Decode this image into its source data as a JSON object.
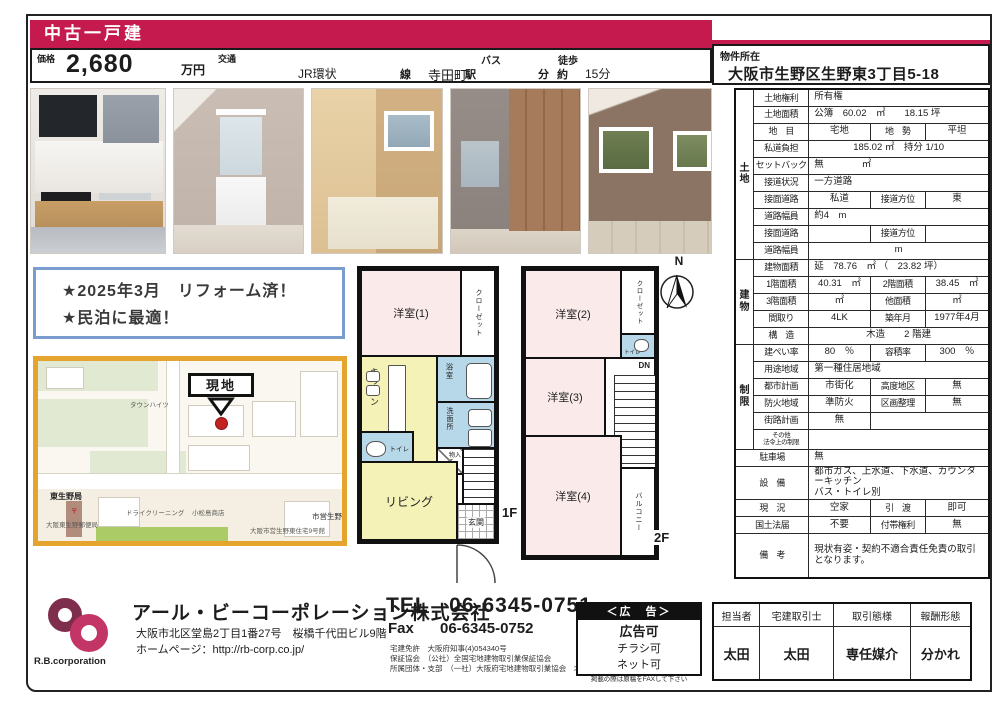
{
  "colors": {
    "crimson": "#c41a4e",
    "map_border": "#e4a42e",
    "callout_blue": "#7b9cce",
    "plan_pink": "#fbeaea",
    "plan_yellow": "#f4f2b6",
    "plan_blue": "#b7d8e9",
    "logo_maroon": "#7e2d4c",
    "logo_pink": "#c23566"
  },
  "header": {
    "category": "中古一戸建",
    "price_label": "価格",
    "price_value": "2,680",
    "price_unit": "万円",
    "transport_label": "交通",
    "bus_label": "バス",
    "walk_label": "徒歩",
    "line_name": "JR環状",
    "line_suffix": "線",
    "station": "寺田町",
    "station_suffix": "駅",
    "minutes_label": "分",
    "approx_label": "約",
    "walk_time": "15分",
    "location_label": "物件所在",
    "address": "大阪市生野区生野東3丁目5-18"
  },
  "photos": [
    "kitchen-photo",
    "vanity-photo",
    "bathroom-photo",
    "room-closet-photo",
    "western-room-photo"
  ],
  "highlights": {
    "line1": "★2025年3月　リフォーム済！",
    "line2": "★民泊に最適！"
  },
  "map": {
    "site_label": "現地",
    "labels": [
      "タウンハイツ",
      "東生野局",
      "〒",
      "大阪東生野郵便局",
      "ドライクリーニング",
      "小松島商店",
      "市営生野",
      "大阪市営生野東住宅9号館"
    ]
  },
  "floorplan": {
    "f1": {
      "floor_label": "1F",
      "room1": "洋室(1)",
      "closet": "クローゼット",
      "kitchen": "キッチン",
      "bath": "浴室",
      "wash": "洗面所",
      "toilet": "トイレ",
      "storage": "物入",
      "living": "リビング",
      "entrance": "玄関",
      "up": "UP"
    },
    "f2": {
      "floor_label": "2F",
      "room2": "洋室(2)",
      "closet": "クローゼット",
      "toilet": "トイレ",
      "room3": "洋室(3)",
      "down": "DN",
      "room4": "洋室(4)",
      "balcony": "バルコニー"
    },
    "compass": "N"
  },
  "spec_table": {
    "rows": [
      {
        "cells": [
          {
            "t": "土\n地",
            "grp": true,
            "rs": 10
          },
          {
            "t": "土地権利",
            "lbl": true
          },
          {
            "t": "所有権",
            "cs": 3,
            "al": "l"
          }
        ]
      },
      {
        "cells": [
          {
            "t": "土地面積",
            "lbl": true
          },
          {
            "t": "公簿　60.02　㎡　　18.15 坪",
            "cs": 3,
            "al": "l"
          }
        ]
      },
      {
        "cells": [
          {
            "t": "地　目",
            "lbl": true
          },
          {
            "t": "宅地"
          },
          {
            "t": "地　勢",
            "lbl": true
          },
          {
            "t": "平坦"
          }
        ]
      },
      {
        "cells": [
          {
            "t": "私道負担",
            "lbl": true
          },
          {
            "t": "185.02 ㎡　持分 1/10",
            "cs": 3
          }
        ]
      },
      {
        "cells": [
          {
            "t": "セットバック",
            "lbl": true
          },
          {
            "t": "無　　　　㎡",
            "cs": 3,
            "al": "l"
          }
        ]
      },
      {
        "cells": [
          {
            "t": "接道状況",
            "lbl": true
          },
          {
            "t": "一方道路",
            "cs": 3,
            "al": "l"
          }
        ]
      },
      {
        "cells": [
          {
            "t": "接面道路",
            "lbl": true
          },
          {
            "t": "私道"
          },
          {
            "t": "接道方位",
            "lbl": true
          },
          {
            "t": "東"
          }
        ]
      },
      {
        "cells": [
          {
            "t": "道路幅員",
            "lbl": true
          },
          {
            "t": "約4　m",
            "cs": 3,
            "al": "l"
          }
        ]
      },
      {
        "cells": [
          {
            "t": "接面道路",
            "lbl": true
          },
          {
            "t": ""
          },
          {
            "t": "接道方位",
            "lbl": true
          },
          {
            "t": ""
          }
        ]
      },
      {
        "cells": [
          {
            "t": "道路幅員",
            "lbl": true
          },
          {
            "t": "m",
            "cs": 3
          }
        ]
      },
      {
        "cells": [
          {
            "t": "建\n物",
            "grp": true,
            "rs": 5
          },
          {
            "t": "建物面積",
            "lbl": true
          },
          {
            "t": "延　78.76　㎡ （　23.82 坪）",
            "cs": 3,
            "al": "l"
          }
        ]
      },
      {
        "cells": [
          {
            "t": "1階面積",
            "lbl": true
          },
          {
            "t": "40.31　㎡"
          },
          {
            "t": "2階面積",
            "lbl": true
          },
          {
            "t": "38.45　㎡"
          }
        ]
      },
      {
        "cells": [
          {
            "t": "3階面積",
            "lbl": true
          },
          {
            "t": "㎡"
          },
          {
            "t": "他面積",
            "lbl": true
          },
          {
            "t": "㎡"
          }
        ]
      },
      {
        "cells": [
          {
            "t": "間取り",
            "lbl": true
          },
          {
            "t": "4LK"
          },
          {
            "t": "築年月",
            "lbl": true
          },
          {
            "t": "1977年4月"
          }
        ]
      },
      {
        "cells": [
          {
            "t": "構　造",
            "lbl": true
          },
          {
            "t": "木造　　2 階建",
            "cs": 3
          }
        ]
      },
      {
        "cells": [
          {
            "t": "制\n限",
            "grp": true,
            "rs": 6
          },
          {
            "t": "建ぺい率",
            "lbl": true
          },
          {
            "t": "80　％"
          },
          {
            "t": "容積率",
            "lbl": true
          },
          {
            "t": "300　％"
          }
        ]
      },
      {
        "cells": [
          {
            "t": "用途地域",
            "lbl": true
          },
          {
            "t": "第一種住居地域",
            "cs": 3,
            "al": "l"
          }
        ]
      },
      {
        "cells": [
          {
            "t": "都市計画",
            "lbl": true
          },
          {
            "t": "市街化"
          },
          {
            "t": "高度地区",
            "lbl": true
          },
          {
            "t": "無"
          }
        ]
      },
      {
        "cells": [
          {
            "t": "防火地域",
            "lbl": true
          },
          {
            "t": "準防火"
          },
          {
            "t": "区画整理",
            "lbl": true
          },
          {
            "t": "無"
          }
        ]
      },
      {
        "cells": [
          {
            "t": "街路計画",
            "lbl": true
          },
          {
            "t": "無"
          },
          {
            "t": "",
            "cs": 2
          }
        ]
      },
      {
        "h": 20,
        "cells": [
          {
            "t": "その他\n法令上の制限",
            "lbl": true,
            "sm": true
          },
          {
            "t": "",
            "cs": 3
          }
        ]
      },
      {
        "cells": [
          {
            "t": "駐車場",
            "lbl": true,
            "cs": 2
          },
          {
            "t": "無",
            "cs": 3,
            "al": "l"
          }
        ]
      },
      {
        "h": 32,
        "cells": [
          {
            "t": "設　備",
            "lbl": true,
            "cs": 2
          },
          {
            "t": "都市ガス、上水道、下水道、カウンターキッチン\nバス・トイレ別",
            "cs": 3,
            "al": "l"
          }
        ]
      },
      {
        "cells": [
          {
            "t": "現　況",
            "lbl": true,
            "cs": 2
          },
          {
            "t": "空家"
          },
          {
            "t": "引　渡",
            "lbl": true
          },
          {
            "t": "即可"
          }
        ]
      },
      {
        "cells": [
          {
            "t": "国土法届",
            "lbl": true,
            "cs": 2
          },
          {
            "t": "不要"
          },
          {
            "t": "付帯権利",
            "lbl": true
          },
          {
            "t": "無"
          }
        ]
      },
      {
        "h": 44,
        "cells": [
          {
            "t": "備　考",
            "lbl": true,
            "cs": 2
          },
          {
            "t": "現状有姿・契約不適合責任免責の取引となります。",
            "cs": 3,
            "al": "l"
          }
        ]
      }
    ]
  },
  "footer": {
    "logo_caption": "R.B.corporation",
    "company_name": "アール・ビーコーポレーション株式会社",
    "company_address": "大阪市北区堂島2丁目1番27号　桜橋千代田ビル9階",
    "homepage": "ホームページ：http://rb-corp.co.jp/",
    "tel_label": "TEL",
    "tel": "06-6345-0751",
    "fax_label": "Fax",
    "fax": "06-6345-0752",
    "licenses": [
      "宅建免許　大阪府知事(4)054340号",
      "保証協会　（公社）全国宅地建物取引業保証協会",
      "所属団体・支部　（一社）大阪府宅地建物取引業協会　北支部"
    ],
    "ad": {
      "title": "＜広　告＞",
      "line1": "広告可",
      "line2": "チラシ可",
      "line3": "ネット可",
      "note": "掲載の際は原稿をFAXして下さい"
    },
    "agents": {
      "headers": [
        "担当者",
        "宅建取引士",
        "取引態様",
        "報酬形態"
      ],
      "values": [
        "太田",
        "太田",
        "専任媒介",
        "分かれ"
      ]
    }
  }
}
